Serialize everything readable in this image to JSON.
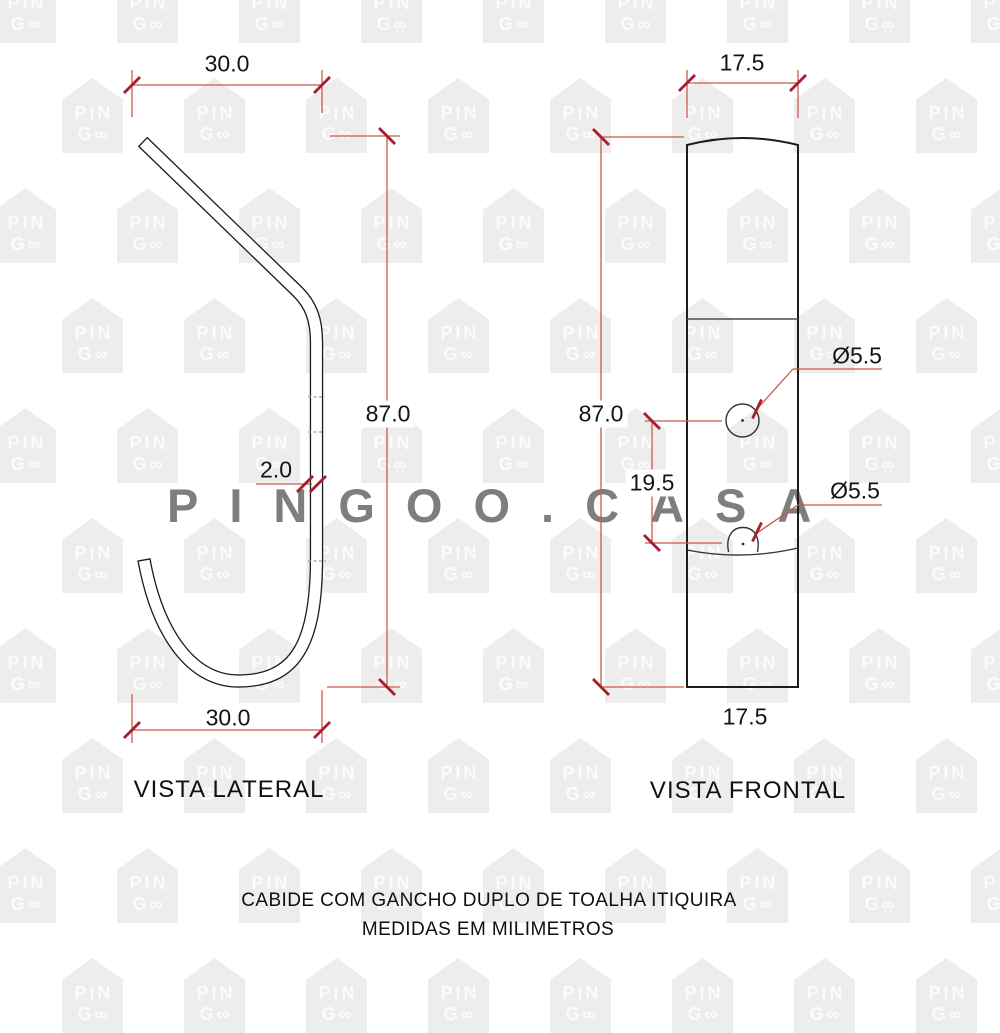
{
  "watermark": {
    "big_text": "PINGOO.CASA",
    "house_line1": "PIN",
    "house_line2": "G∞"
  },
  "side_view": {
    "label": "VISTA LATERAL",
    "top_width_mm": "30.0",
    "bottom_width_mm": "30.0",
    "height_mm": "87.0",
    "thickness_mm": "2.0"
  },
  "front_view": {
    "label": "VISTA FRONTAL",
    "top_width_mm": "17.5",
    "bottom_width_mm": "17.5",
    "height_mm": "87.0",
    "hole_spacing_mm": "19.5",
    "hole_diameter_top": "Ø5.5",
    "hole_diameter_bottom": "Ø5.5"
  },
  "footer": {
    "title": "CABIDE COM GANCHO DUPLO DE TOALHA ITIQUIRA",
    "units_note": "MEDIDAS EM MILIMETROS"
  },
  "colors": {
    "dimension_line": "#c85a49",
    "dimension_tick": "#a81e2c",
    "drawing_ink": "#1c1c1c",
    "watermark_gray": "#7e7e7e",
    "house_gray": "#ededed"
  }
}
